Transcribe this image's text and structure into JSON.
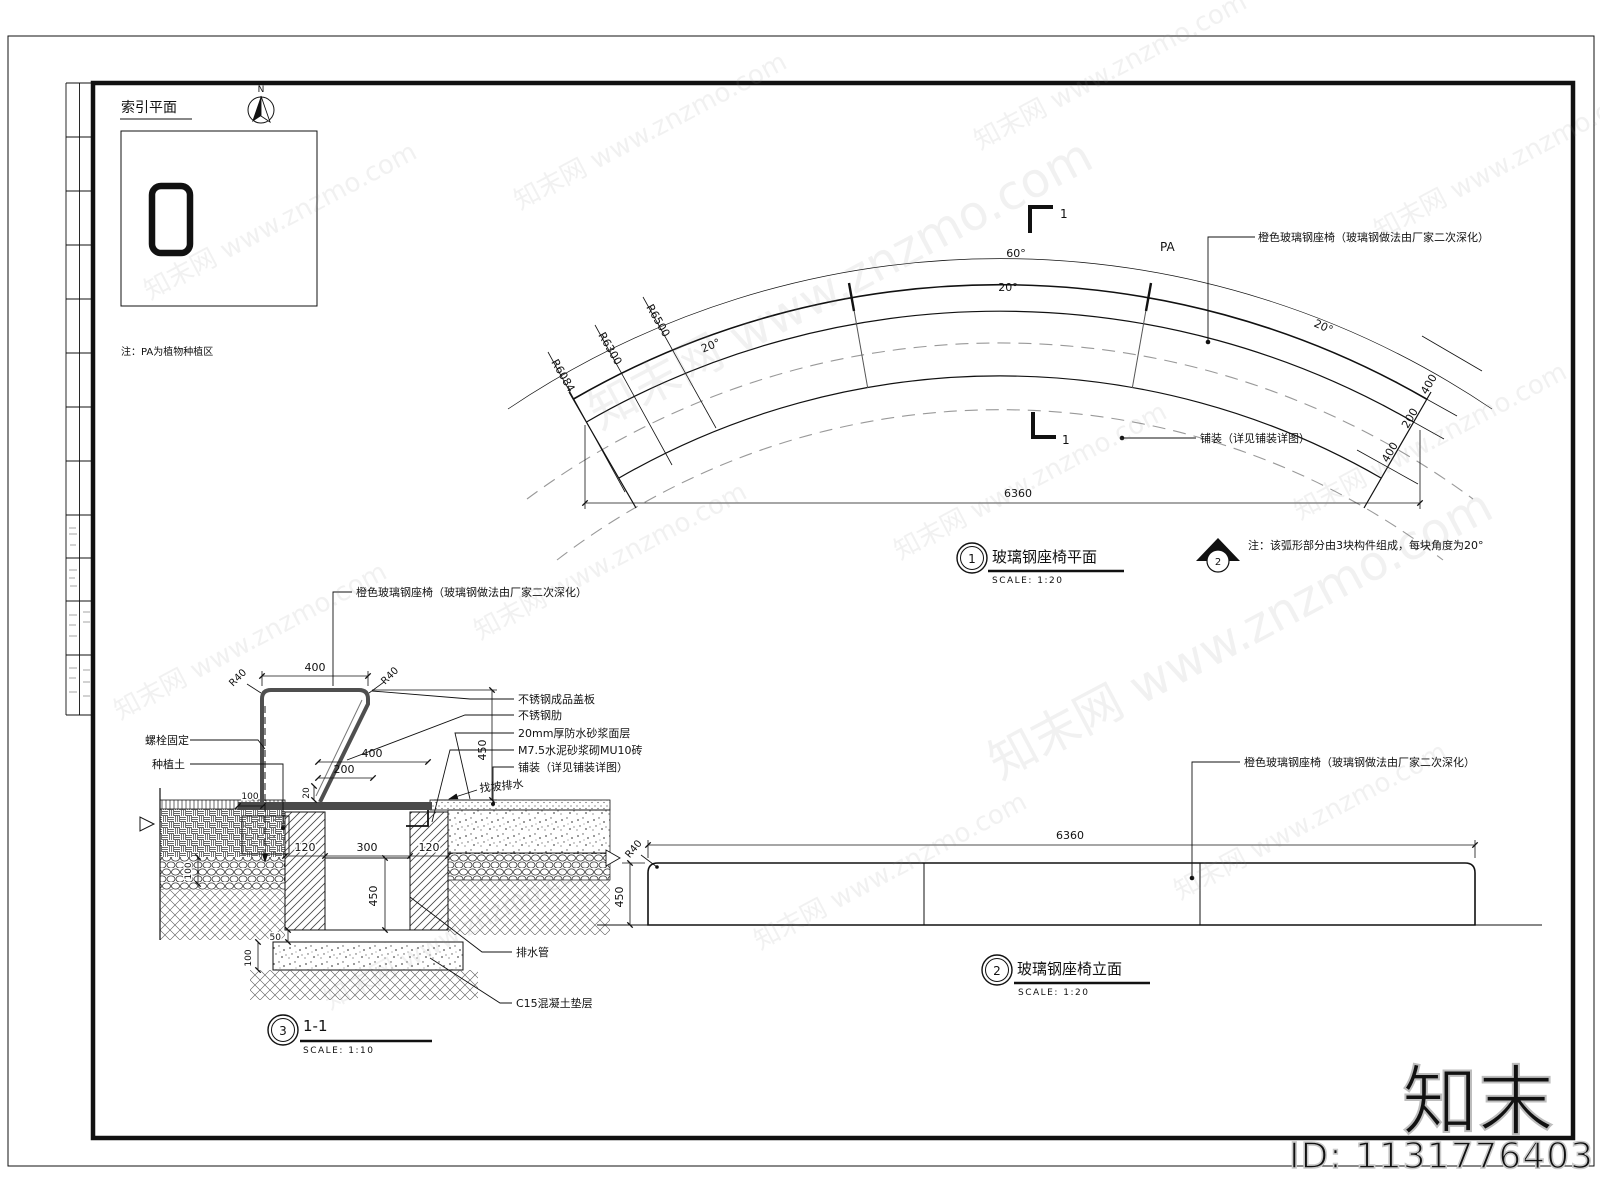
{
  "watermark": {
    "tile": "知末网 www.znzmo.com",
    "logo": "知末",
    "id_label": "ID: 1131776403"
  },
  "index_plan": {
    "title": "索引平面",
    "north": "N",
    "note": "注：PA为植物种植区"
  },
  "plan_view": {
    "cut_top": "1",
    "cut_bottom": "1",
    "pa": "PA",
    "angle_total": "60°",
    "angle_seg_mid": "20°",
    "angle_seg_left": "20°",
    "angle_seg_right": "20°",
    "radii": [
      "R6084",
      "R6300",
      "R6500"
    ],
    "end_dims": [
      "400",
      "200",
      "400"
    ],
    "callout_seat": "橙色玻璃钢座椅（玻璃钢做法由厂家二次深化）",
    "callout_paving": "铺装（详见铺装详图）",
    "dim_chord": "6360",
    "bubble_no": "1",
    "title": "玻璃钢座椅平面",
    "scale": "SCALE: 1:20",
    "elev_marker_no": "2",
    "note": "注：该弧形部分由3块构件组成，每块角度为20°"
  },
  "section_view": {
    "callout_seat": "橙色玻璃钢座椅（玻璃钢做法由厂家二次深化）",
    "callout_bolt": "螺栓固定",
    "callout_soil": "种植土",
    "callout_cover": "不锈钢成品盖板",
    "callout_rib": "不锈钢肋",
    "callout_mortar": "20mm厚防水砂浆面层",
    "callout_brick": "M7.5水泥砂浆砌MU10砖",
    "callout_paving": "铺装（详见铺装详图）",
    "callout_slope": "找坡排水",
    "callout_drain": "排水管",
    "callout_cushion": "C15混凝土垫层",
    "dim_top": "400",
    "r_left": "R40",
    "r_right": "R40",
    "dim_height": "450",
    "dim_mid400": "400",
    "dim_mid200": "200",
    "dim_20": "20",
    "dim_base100": "100",
    "dim_soil100": "100",
    "dim_wall_l": "120",
    "dim_cavity": "300",
    "dim_wall_r": "120",
    "dim_depth": "450",
    "dim_ledge": "50",
    "dim_footing": "100",
    "bubble_no": "3",
    "title": "1-1",
    "scale": "SCALE: 1:10"
  },
  "elevation_view": {
    "callout_seat": "橙色玻璃钢座椅（玻璃钢做法由厂家二次深化）",
    "dim_length": "6360",
    "dim_height": "450",
    "dim_radius": "R40",
    "bubble_no": "2",
    "title": "玻璃钢座椅立面",
    "scale": "SCALE: 1:20"
  }
}
